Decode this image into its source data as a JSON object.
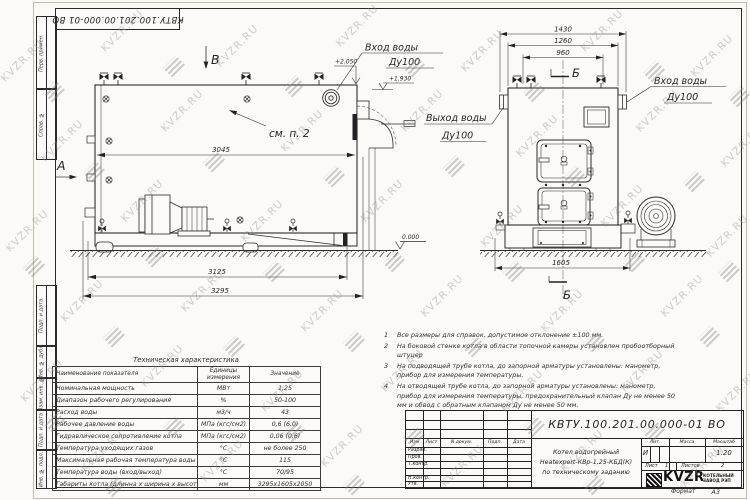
{
  "sheet": {
    "doc_number": "КВТУ.100.201.00.000-01 ВО",
    "format_label": "Формат",
    "format_value": "А3"
  },
  "margin": {
    "labels": [
      "Перв. примен.",
      "Справ. №",
      "Подп. и дата",
      "Инв. № дубл.",
      "Взам. инв. №",
      "Подп. и дата",
      "Инв. № подл."
    ]
  },
  "left_view": {
    "view_label": "В",
    "section_label": "А",
    "callout": "см. п. 2",
    "d3045": "3045",
    "d3125": "3125",
    "d3295": "3295",
    "elev_top": "+2.050",
    "elev_inlet": "+1.930",
    "elev_ground": "0.000",
    "inlet_line1": "Вход воды",
    "inlet_line2": "Ду100"
  },
  "right_view": {
    "section_label_top": "Б",
    "section_label_bottom": "Б",
    "d1430": "1430",
    "d1260": "1260",
    "d960": "960",
    "d1605": "1605",
    "outlet_line1": "Выход воды",
    "outlet_line2": "Ду100",
    "inlet_line1": "Вход воды",
    "inlet_line2": "Ду100"
  },
  "notes": [
    {
      "num": "1",
      "text": "Все размеры для справок, допустимое отклонение ±100 мм."
    },
    {
      "num": "2",
      "text": "На боковой стенке котла в области топочной камеры установлен пробоотборный штуцер"
    },
    {
      "num": "3",
      "text": "На подводящей трубе котла, до запорной арматуры установлены: манометр, прибор для измерения температуры."
    },
    {
      "num": "4",
      "text": "На отводящей трубе котла, до запорной арматуры установлены: манометр, прибор для измерения температуры, предохранительный клапан Ду не менее 50 мм и обвод с обратным клапаном Ду не менее 50 мм."
    }
  ],
  "table": {
    "title": "Техническая характеристика",
    "headers": [
      "Наименование показателя",
      "Единицы измерения",
      "Значение"
    ],
    "rows": [
      [
        "Номинальная мощность",
        "МВт",
        "1,25"
      ],
      [
        "Диапазон рабочего регулирования",
        "%",
        "50-100"
      ],
      [
        "Расход воды",
        "м3/ч",
        "43"
      ],
      [
        "Рабочее давление воды",
        "МПа (кгс/см2)",
        "0,6 (6,0)"
      ],
      [
        "Гидравлическое сопротивление котла",
        "МПа (кгс/см2)",
        "0,06 (0,6)"
      ],
      [
        "Температура уходящих газов",
        "°С",
        "не более 250"
      ],
      [
        "Максимальная рабочая температура воды",
        "°С",
        "115"
      ],
      [
        "Температура воды (вход/выход)",
        "°С",
        "70/95"
      ],
      [
        "Габариты котла (длинна х ширина х высота)",
        "мм",
        "3295х1605х2050"
      ]
    ]
  },
  "title_block": {
    "header_cols": [
      "Изм",
      "Лист",
      "N докум.",
      "Подп.",
      "Дата"
    ],
    "sig_rows": [
      "Разраб.",
      "Пров.",
      "Т.контр.",
      "Н.контр.",
      "Утв."
    ],
    "description": [
      "Котел водогрейный",
      "Heatexpert-КВр-1,25-КБД(К)",
      "по техническому заданию"
    ],
    "lit_header": [
      "Лит.",
      "Масса",
      "Масштаб"
    ],
    "lit_value": "И",
    "scale_value": "1:20",
    "sheet_label": "Лист",
    "sheet_value": "1",
    "sheets_label": "Листов",
    "sheets_value": "2",
    "logo_text": "KVZR",
    "company": [
      "КОТЕЛЬНЫЙ",
      "ЗАВОД РЭП"
    ]
  },
  "watermark": {
    "text": "KVZR.RU",
    "text_positions": [
      [
        -5,
        55
      ],
      [
        95,
        25
      ],
      [
        210,
        40
      ],
      [
        330,
        20
      ],
      [
        455,
        45
      ],
      [
        575,
        25
      ],
      [
        685,
        50
      ],
      [
        35,
        135
      ],
      [
        155,
        105
      ],
      [
        275,
        125
      ],
      [
        395,
        105
      ],
      [
        510,
        130
      ],
      [
        630,
        105
      ],
      [
        715,
        140
      ],
      [
        0,
        225
      ],
      [
        115,
        195
      ],
      [
        235,
        215
      ],
      [
        355,
        195
      ],
      [
        475,
        220
      ],
      [
        595,
        200
      ],
      [
        700,
        230
      ],
      [
        55,
        295
      ],
      [
        175,
        285
      ],
      [
        295,
        305
      ],
      [
        415,
        290
      ],
      [
        535,
        305
      ],
      [
        655,
        290
      ],
      [
        15,
        375
      ],
      [
        135,
        360
      ],
      [
        255,
        385
      ],
      [
        375,
        365
      ],
      [
        495,
        385
      ],
      [
        615,
        365
      ],
      [
        710,
        385
      ],
      [
        75,
        445
      ],
      [
        195,
        455
      ],
      [
        315,
        440
      ],
      [
        435,
        460
      ],
      [
        555,
        445
      ],
      [
        675,
        460
      ]
    ],
    "logo_positions": [
      [
        45,
        85
      ],
      [
        165,
        60
      ],
      [
        285,
        80
      ],
      [
        405,
        60
      ],
      [
        525,
        85
      ],
      [
        645,
        65
      ],
      [
        730,
        90
      ],
      [
        85,
        165
      ],
      [
        205,
        155
      ],
      [
        325,
        170
      ],
      [
        445,
        160
      ],
      [
        565,
        170
      ],
      [
        685,
        175
      ],
      [
        25,
        260
      ],
      [
        145,
        250
      ],
      [
        265,
        265
      ],
      [
        385,
        255
      ],
      [
        505,
        265
      ],
      [
        625,
        255
      ],
      [
        720,
        265
      ],
      [
        105,
        330
      ],
      [
        225,
        340
      ],
      [
        345,
        335
      ],
      [
        465,
        340
      ],
      [
        585,
        335
      ],
      [
        700,
        330
      ],
      [
        45,
        415
      ],
      [
        165,
        420
      ],
      [
        285,
        425
      ],
      [
        405,
        430
      ],
      [
        525,
        420
      ],
      [
        645,
        425
      ],
      [
        105,
        480
      ],
      [
        345,
        478
      ],
      [
        585,
        478
      ]
    ]
  }
}
